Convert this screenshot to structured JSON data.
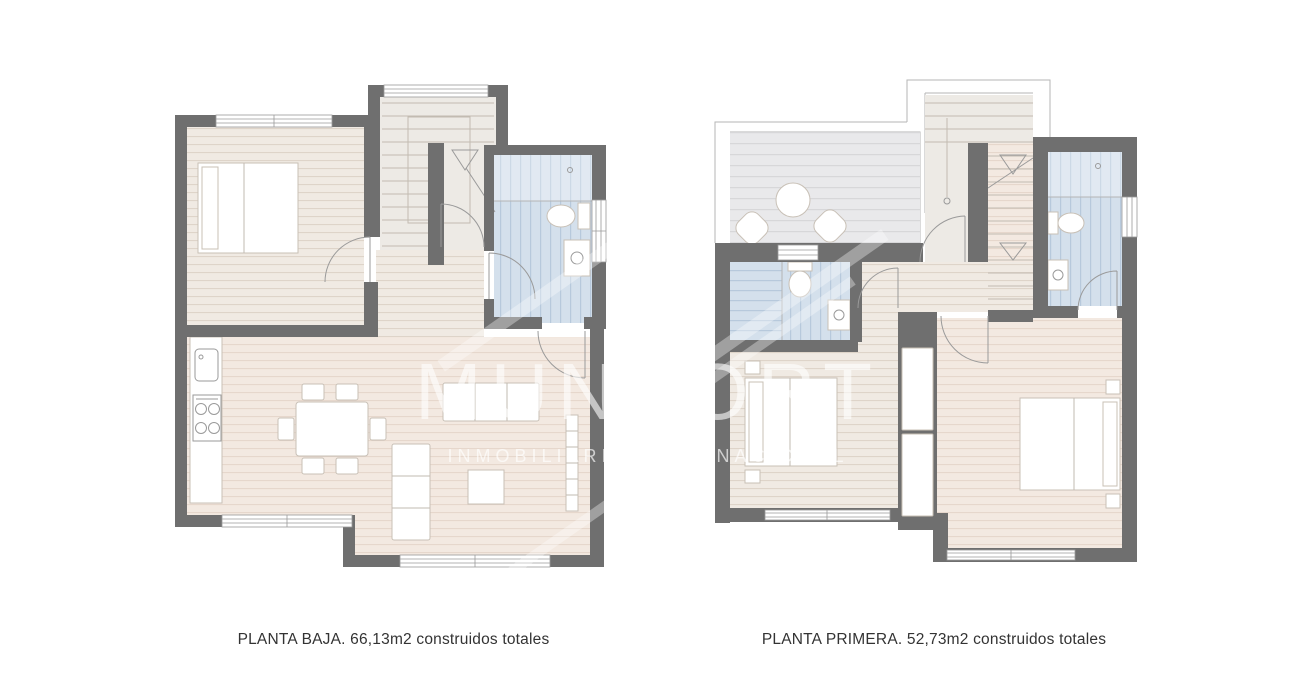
{
  "canvas": {
    "width": 1290,
    "height": 698,
    "background": "#ffffff"
  },
  "palette": {
    "wall": "#6f6f6f",
    "floor_wood": "#f0eae3",
    "floor_wood_stripe": "#ddd1c6",
    "floor_wood_warm": "#f3e9e1",
    "floor_wood_warm_stripe": "#e5d5c9",
    "bath_tile": "#d4e0ec",
    "bath_tile_stripe": "#b7c9dc",
    "deck": "#e9e9eb",
    "deck_stripe": "#d7d7d9",
    "stair_floor": "#edeae5",
    "furniture": "#ffffff",
    "furniture_outline": "#c8c0b6",
    "thin_line": "#c2bbb1",
    "caption_text": "#333333"
  },
  "watermark": {
    "brand": "MUNPORT",
    "tagline": "INMOBILIARIA INTERNACIONAL"
  },
  "plans": [
    {
      "caption": "PLANTA BAJA. 66,13m2 construidos totales"
    },
    {
      "caption": "PLANTA PRIMERA. 52,73m2 construidos totales"
    }
  ]
}
